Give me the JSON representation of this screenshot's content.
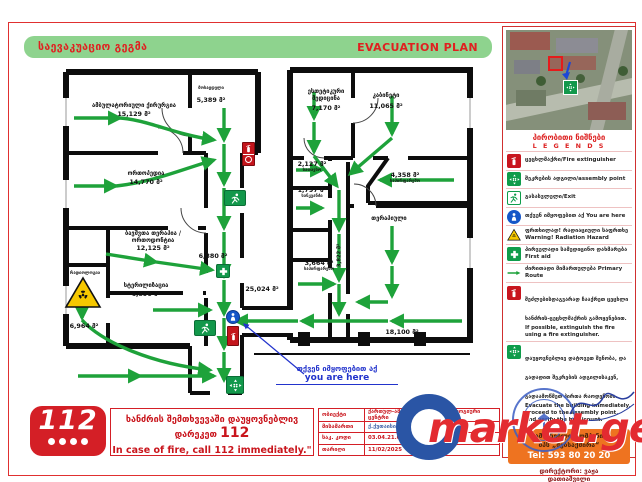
{
  "colors": {
    "header_green": "#8ed38e",
    "accent_red": "#d41f26",
    "arrow_green": "#1ea23a",
    "orange_box": "#ee7320",
    "you_are_here_blue": "#1556c8",
    "radiation_yellow": "#f6c800"
  },
  "header": {
    "title_ka": "საევაკუაციო გეგმა",
    "title_en": "EVACUATION PLAN"
  },
  "plan": {
    "you_are_here_ka": "თქვენ იმყოფებით აქ",
    "you_are_here_en": "you are here",
    "rooms": [
      {
        "name": "ამბულატორიული ქირურგია",
        "area": "15,129 მ²"
      },
      {
        "name": "მოსაცდელი",
        "area": "5,389 მ²"
      },
      {
        "name": "ორთოპედია",
        "area": "14,770 მ²"
      },
      {
        "name": "ბავშვთა თერაპია / ორთოდონტია",
        "area": "12,125 მ²"
      },
      {
        "name": "სტერილიზაცია",
        "area": "6,890 მ²"
      },
      {
        "name": "რადიოლოგია",
        "area": "6,964 მ²"
      },
      {
        "name": "",
        "area": "6,880 მ²"
      },
      {
        "name": "",
        "area": "25,024 მ²"
      },
      {
        "name": "სათავსო",
        "area": "2,127 მ²"
      },
      {
        "name": "სანკვანძი",
        "area": "1,797 მ²"
      },
      {
        "name": "საპირფარეშო",
        "area": "3,664 მ²"
      },
      {
        "name": "",
        "area": "3,822 მ²"
      },
      {
        "name": "ესთეტიკური მედიცინა",
        "area": "7,170 მ²"
      },
      {
        "name": "კაბინეტი",
        "area": "11,065 მ²"
      },
      {
        "name": "საპირფარეშო",
        "area": "4,358 მ²"
      },
      {
        "name": "თერაპიული",
        "area": "18,100 მ²"
      }
    ]
  },
  "sidebar": {
    "legend_title_ka": "პირობითი ნიშნები",
    "legend_title_en": "L E G E N D S",
    "legend": [
      {
        "icon": "fire-extinguisher",
        "label": "ცეცხლმაქრი/Fire extinguisher"
      },
      {
        "icon": "assembly-point",
        "label": "შეკრების ადგილი/assembly point"
      },
      {
        "icon": "exit",
        "label": "გასასვლელი/Exit"
      },
      {
        "icon": "you-are-here",
        "label": "თქვენ იმყოფებით აქ You are here"
      },
      {
        "icon": "radiation",
        "label": "ფრთხილად! რადიაციული საფრთხე Warning! Radiation Hazard"
      },
      {
        "icon": "first-aid",
        "label": "პირველადი სამედიცინო დახმარება First aid"
      },
      {
        "icon": "primary-route",
        "label": "ძირითადი მიმართულება Primary Route"
      }
    ],
    "instructions": [
      {
        "icon": "fire-extinguisher",
        "ka": "შეძლებისდაგვარად ჩააქრეთ ცეცხლი ხანძრის-ცეცხლმაქრის გამოყენებით.",
        "en": "If possible, extinguish the fire using a fire extinguisher."
      },
      {
        "icon": "assembly-point",
        "ka": "დაუყოვნებლივ დატოვეთ შენობა, და გადადით შეკრების ადგილისაკენ, გადაამოწმეთ პირთა რაოდენობა.",
        "en": "Evacuate the building immediately, proceed to the assembly point, and verify the headcount."
      }
    ],
    "company_line1": "სამშენებლო კომპანია",
    "company_line2": "შპს „მებსაქმირა“",
    "company_tel": "Tel: 593 80 20 20",
    "director_line1": "დირექტორი: ვაჟა",
    "director_line2": "დათიაშვილი"
  },
  "footer": {
    "logo": "112",
    "fire_ka": "ხანძრის შემთხვევაში დაუყოვნებლივ დარეკეთ",
    "fire_112": "112",
    "fire_en": "In case of fire, call 112 immediately.\"",
    "table": [
      {
        "label": "ობიექტი",
        "value": "ქართულ-ამერიკული სტომატოლოგიური ცენტრი"
      },
      {
        "label": "მისამართი",
        "value": "ქ.ქუთაისი, ი. ახმეტელის №2"
      },
      {
        "label": "საკ. კოდი",
        "value": "03.04.21.003"
      },
      {
        "label": "თარიღი",
        "value": "11/02/2025"
      }
    ]
  },
  "watermark": "market.ge"
}
